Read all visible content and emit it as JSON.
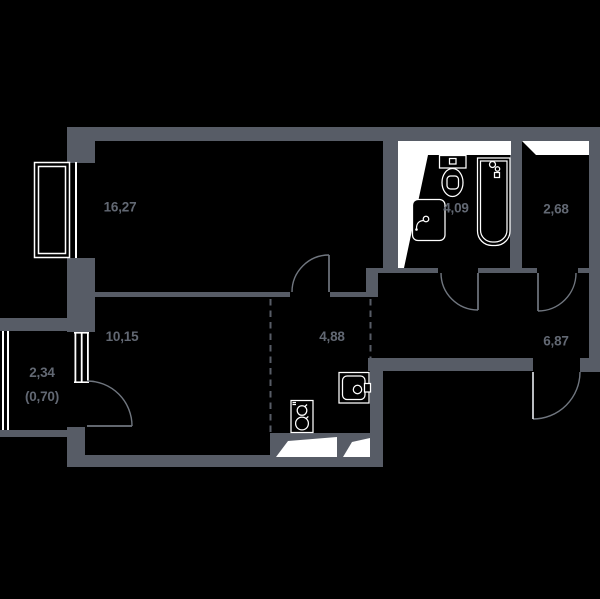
{
  "floorplan": {
    "colors": {
      "background": "#000000",
      "wall": "#575c66",
      "vent": "#ffffff",
      "fixture": "#ffffff",
      "label": "#626873",
      "door": "#70767f",
      "entrance_leaf": "#dbdee2"
    },
    "rooms": [
      {
        "name": "room-16-27",
        "area": "16,27"
      },
      {
        "name": "room-10-15",
        "area": "10,15"
      },
      {
        "name": "balcony",
        "area": "2,34",
        "area_secondary": "(0,70)"
      },
      {
        "name": "kitchen",
        "area": "4,88"
      },
      {
        "name": "bathroom",
        "area": "4,09"
      },
      {
        "name": "wc",
        "area": "2,68"
      },
      {
        "name": "hallway",
        "area": "6,87"
      }
    ]
  }
}
